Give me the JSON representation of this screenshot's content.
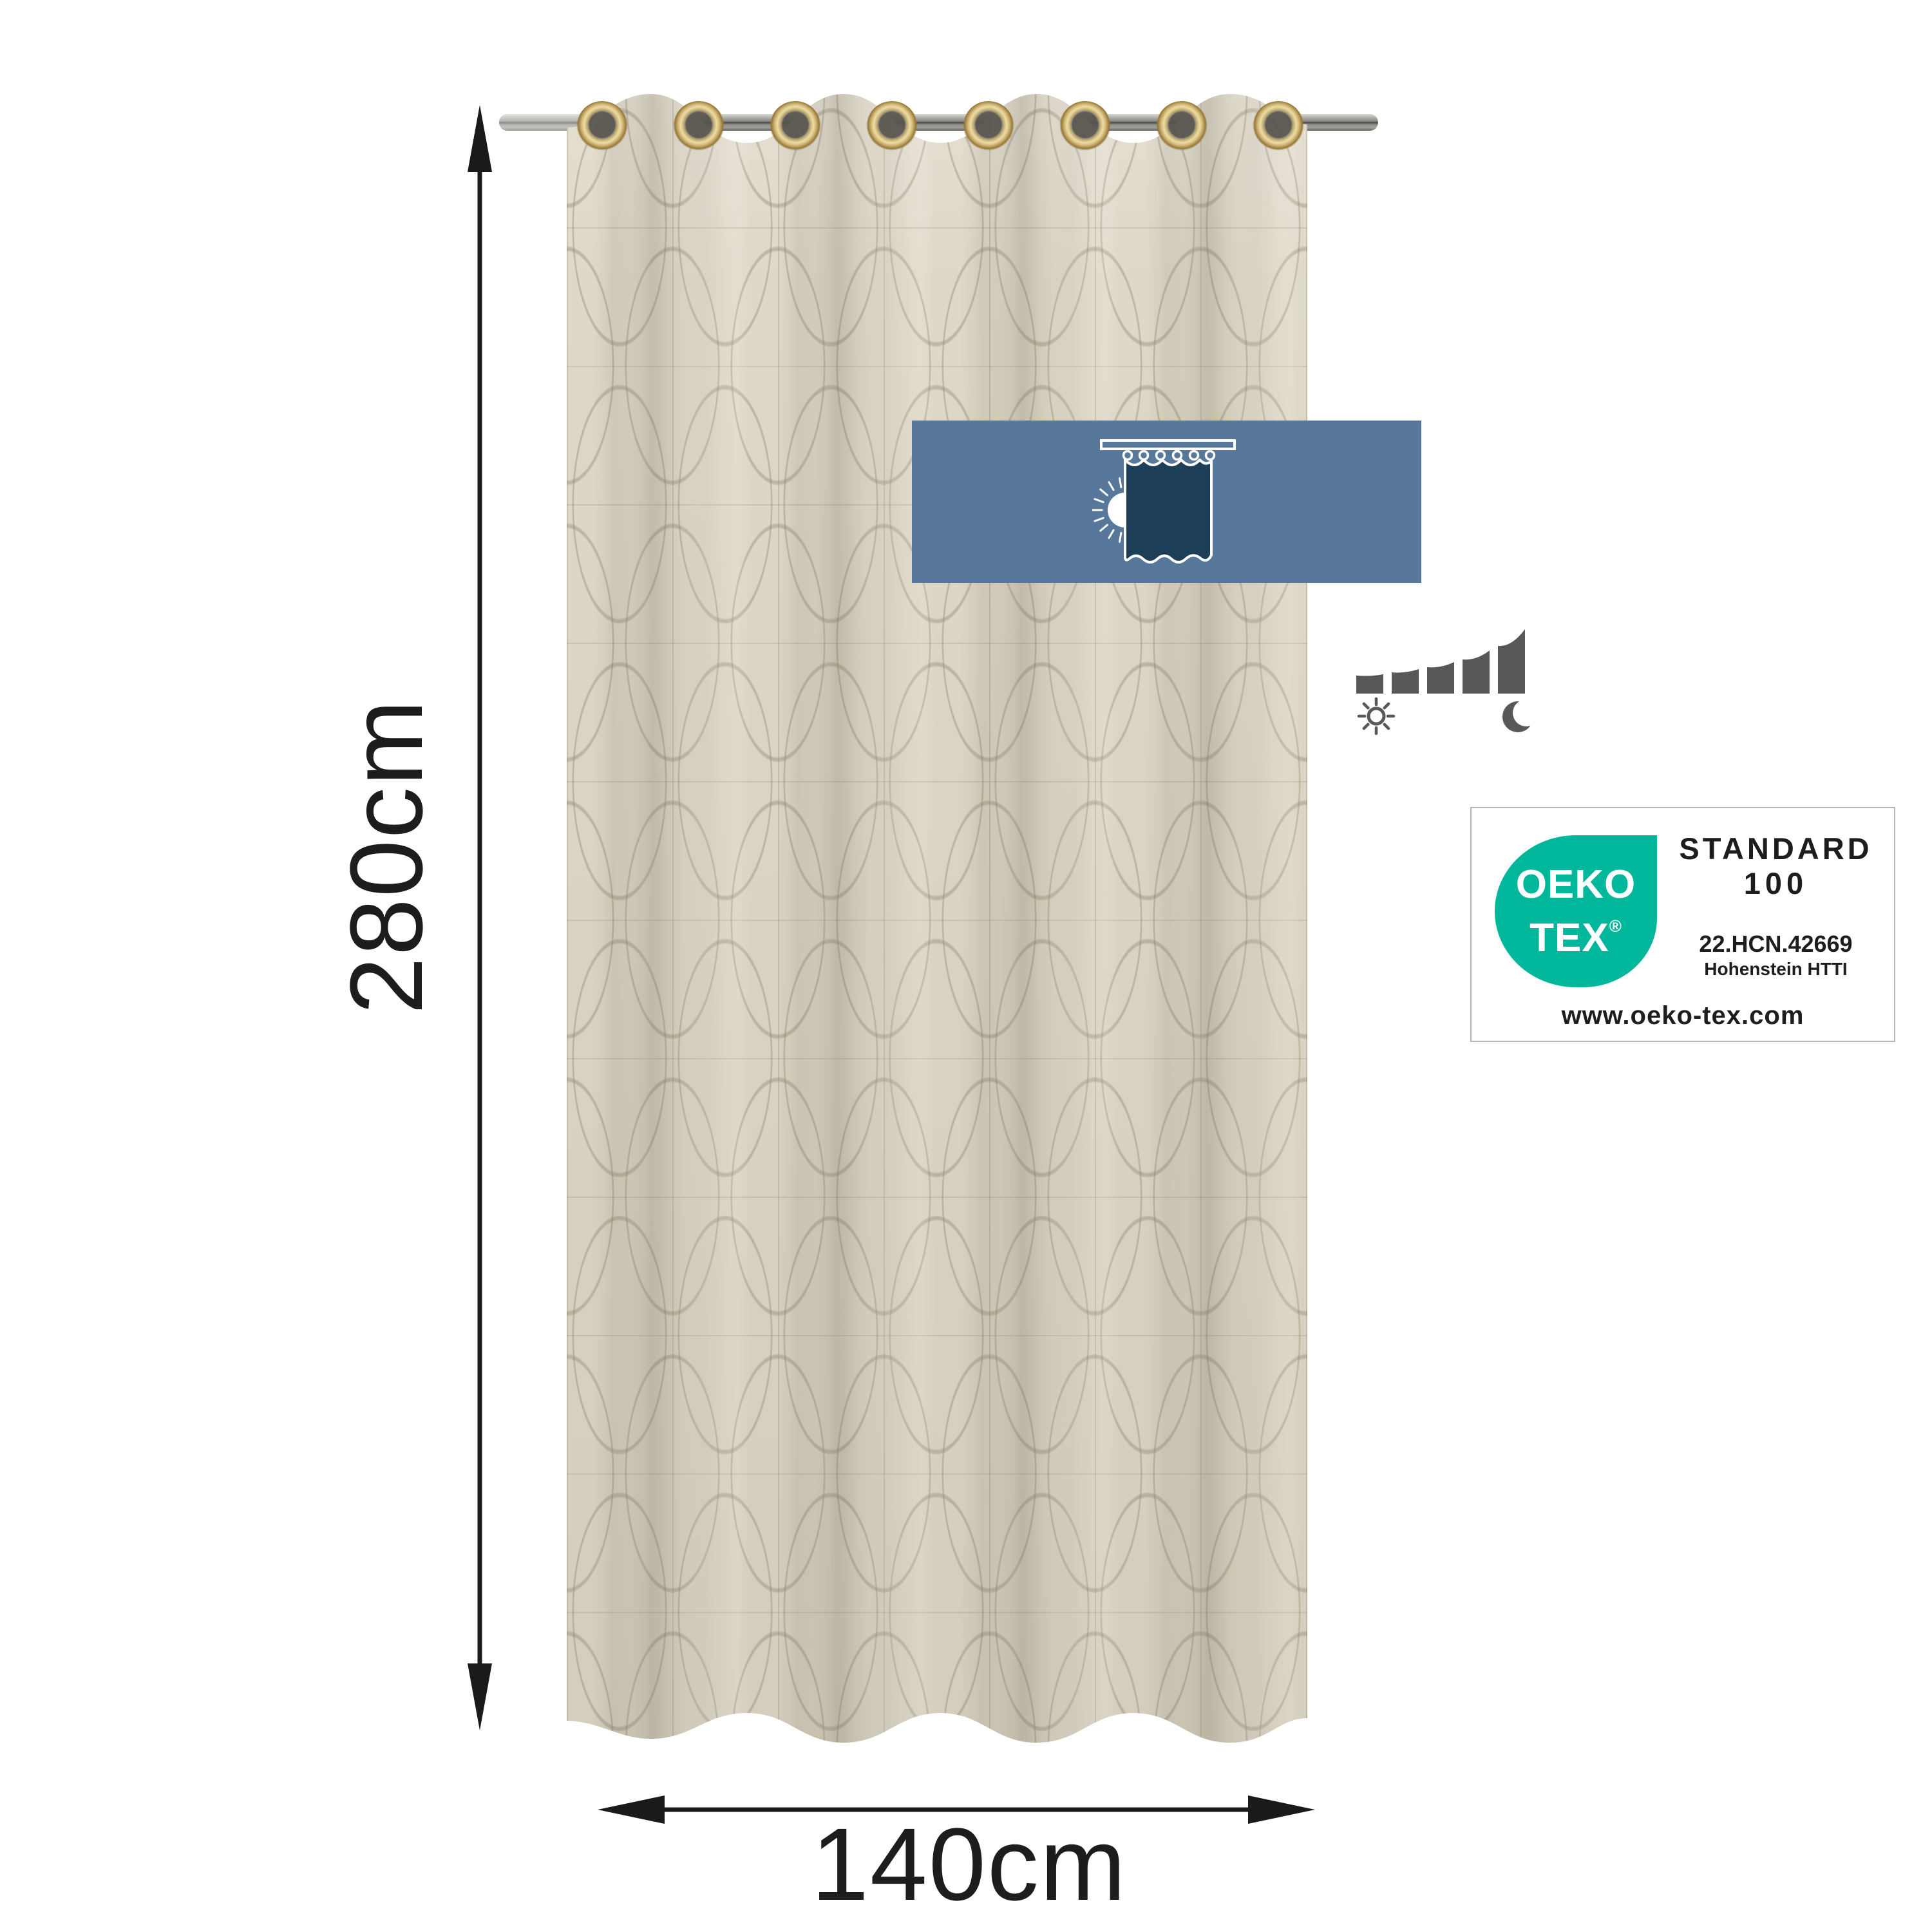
{
  "product": {
    "type": "eyelet-curtain-dimension-image",
    "fabric_color": "#ded8c8",
    "eyelet_count": 8,
    "eyelet_color": "#cab272",
    "rod_color": "#8e8d89"
  },
  "dimensions": {
    "height_label": "280cm",
    "width_label": "140cm",
    "arrow_color": "#1a1a1a"
  },
  "banner": {
    "background": "#57789b",
    "icon": "curtain-blocking-light-icon",
    "icon_curtain_color": "#1c3f57",
    "icon_stroke_color": "#ffffff"
  },
  "light_scale": {
    "bar_count": 5,
    "color": "#58585a",
    "left_icon": "sun-icon",
    "right_icon": "moon-icon"
  },
  "certificate": {
    "logo_line1": "OEKO",
    "logo_line2": "TEX",
    "registered_mark": "®",
    "logo_color": "#00b79b",
    "title_line1": "STANDARD",
    "title_line2": "100",
    "number": "22.HCN.42669",
    "institute": "Hohenstein HTTI",
    "website": "www.oeko-tex.com",
    "text_color": "#1d1d1b",
    "border_color": "#b5b5b5"
  }
}
